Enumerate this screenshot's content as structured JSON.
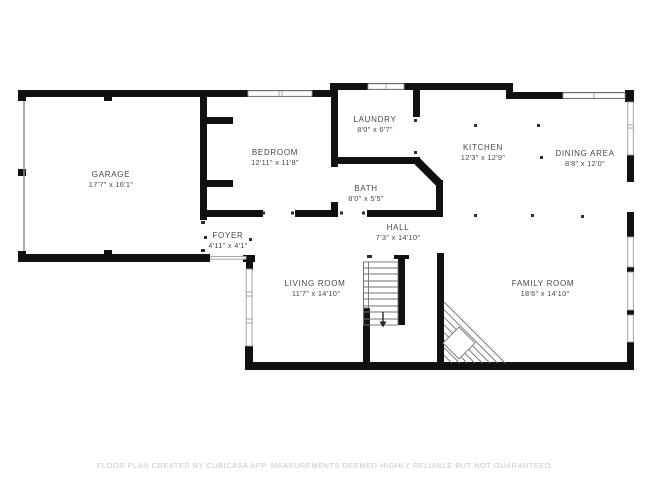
{
  "plan": {
    "rooms": [
      {
        "id": "garage",
        "name": "GARAGE",
        "dims": "17'7\" x 16'1\""
      },
      {
        "id": "bedroom",
        "name": "BEDROOM",
        "dims": "12'11\" x 11'8\""
      },
      {
        "id": "laundry",
        "name": "LAUNDRY",
        "dims": "8'0\" x 6'7\""
      },
      {
        "id": "kitchen",
        "name": "KITCHEN",
        "dims": "12'3\" x 12'9\""
      },
      {
        "id": "dining_area",
        "name": "DINING AREA",
        "dims": "8'8\" x 12'0\""
      },
      {
        "id": "bath",
        "name": "BATH",
        "dims": "8'0\" x 5'5\""
      },
      {
        "id": "foyer",
        "name": "FOYER",
        "dims": "4'11\" x 4'1\""
      },
      {
        "id": "hall",
        "name": "HALL",
        "dims": "7'3\" x 14'10\""
      },
      {
        "id": "living_room",
        "name": "LIVING ROOM",
        "dims": "11'7\" x 14'10\""
      },
      {
        "id": "family_room",
        "name": "FAMILY ROOM",
        "dims": "18'6\" x 14'10\""
      }
    ],
    "footer": "FLOOR PLAN CREATED BY CUBICASA APP. MEASUREMENTS DEEMED HIGHLY RELIABLE BUT NOT GUARANTEED.",
    "colors": {
      "wall": "#111111",
      "label_text": "#474747",
      "footer_text": "#c8c8c8",
      "window_stroke": "#9a9a9a",
      "stair_line": "#777777"
    }
  }
}
